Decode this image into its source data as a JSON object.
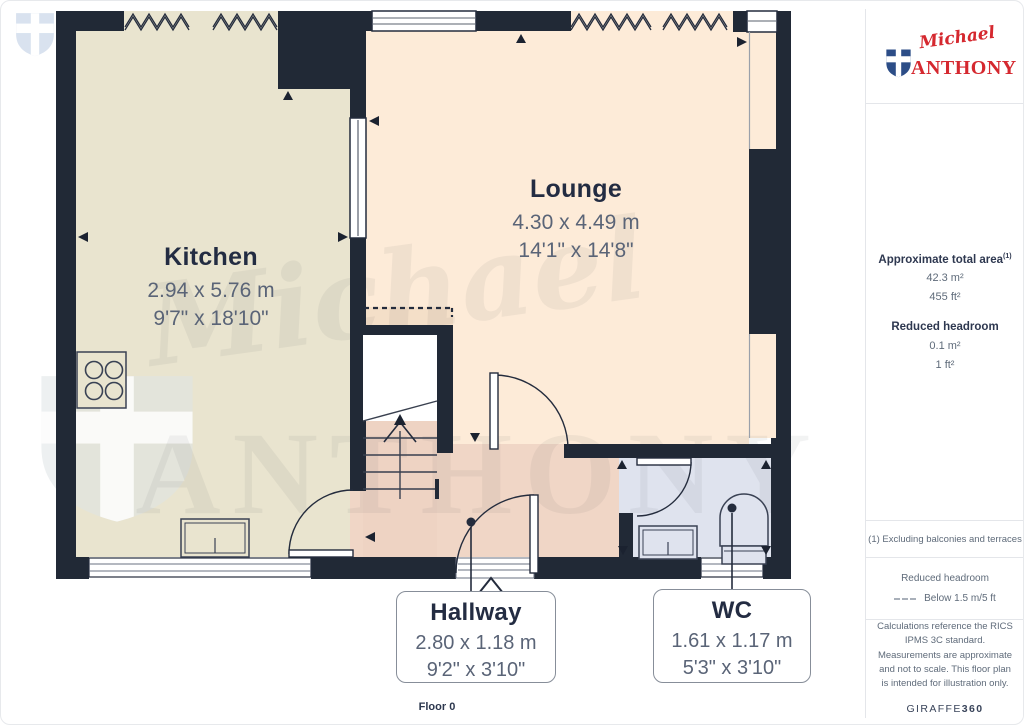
{
  "page": {
    "floor_label": "Floor 0"
  },
  "plan": {
    "rooms": [
      {
        "name": "Kitchen",
        "metric": "2.94 x 5.76 m",
        "imperial": "9'7\" x 18'10\""
      },
      {
        "name": "Lounge",
        "metric": "4.30 x 4.49 m",
        "imperial": "14'1\" x 14'8\""
      },
      {
        "name": "Hallway",
        "metric": "2.80 x 1.18 m",
        "imperial": "9'2\" x 3'10\""
      },
      {
        "name": "WC",
        "metric": "1.61 x 1.17 m",
        "imperial": "5'3\" x 3'10\""
      }
    ],
    "colors": {
      "wall": "#212936",
      "kitchen": "#e9e4cf",
      "lounge": "#fdebd8",
      "hallway": "#f0d6c6",
      "wc": "#dfe3ee",
      "reduced_headroom": "#f4dfc8"
    }
  },
  "watermark": {
    "script": "Michael",
    "caps": "ANTHONY"
  },
  "sidebar": {
    "brand": {
      "script": "Michael",
      "caps": "ANTHONY",
      "red": "#d5282f",
      "blue": "#2c4d87"
    },
    "total_area": {
      "label": "Approximate total area",
      "marker": "(1)",
      "metric": "42.3 m²",
      "imperial": "455 ft²"
    },
    "reduced_headroom": {
      "label": "Reduced headroom",
      "metric": "0.1 m²",
      "imperial": "1 ft²"
    },
    "footnote": "(1) Excluding balconies and terraces",
    "legend": {
      "title": "Reduced headroom",
      "item": "Below 1.5 m/5 ft"
    },
    "disclaimer": "Calculations reference the RICS IPMS 3C standard. Measurements are approximate and not to scale. This floor plan is intended for illustration only.",
    "credit": {
      "name": "GIRAFFE",
      "suffix": "360"
    }
  }
}
